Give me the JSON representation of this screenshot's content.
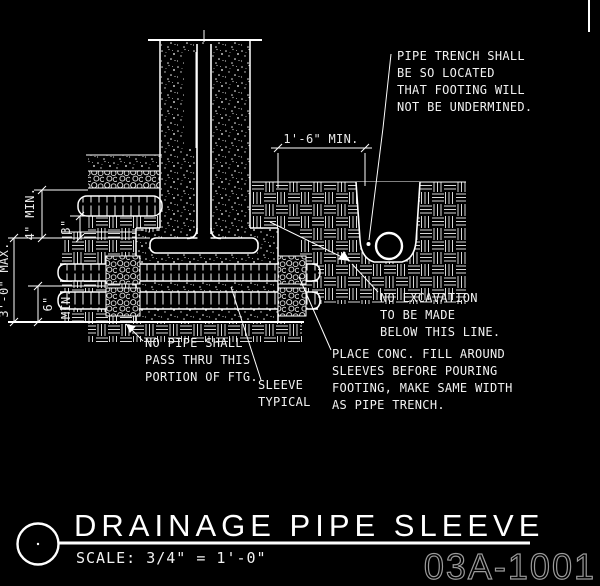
{
  "drawing": {
    "title": "DRAINAGE PIPE SLEEVE",
    "scale": "SCALE: 3/4\" = 1'-0\"",
    "sheet_number": "03A-1001"
  },
  "dimensions": {
    "trench_width": "1'-6\" MIN.",
    "three_in": "3\"",
    "four_in": "4\" MIN.",
    "three_ft_max": "3'-0\" MAX.",
    "six_in": "6\"",
    "six_in_suffix": "MIN."
  },
  "notes": {
    "pipe_trench": {
      "lines": [
        "PIPE TRENCH SHALL",
        "BE SO LOCATED",
        "THAT FOOTING WILL",
        "NOT BE UNDERMINED."
      ]
    },
    "no_excavation": {
      "lines": [
        "NO EXCAVATION",
        "TO BE MADE",
        "BELOW THIS LINE."
      ]
    },
    "no_pipe": {
      "lines": [
        "NO PIPE SHALL",
        "PASS THRU THIS",
        "PORTION OF FTG."
      ]
    },
    "sleeve": {
      "lines": [
        "SLEEVE",
        "TYPICAL"
      ]
    },
    "conc_fill": {
      "lines": [
        "PLACE CONC. FILL AROUND",
        "SLEEVES BEFORE POURING",
        "FOOTING, MAKE SAME WIDTH",
        "AS PIPE TRENCH."
      ]
    }
  },
  "colors": {
    "background": "#000000",
    "line": "#ffffff",
    "sheet_number": "#9b9b9b"
  }
}
